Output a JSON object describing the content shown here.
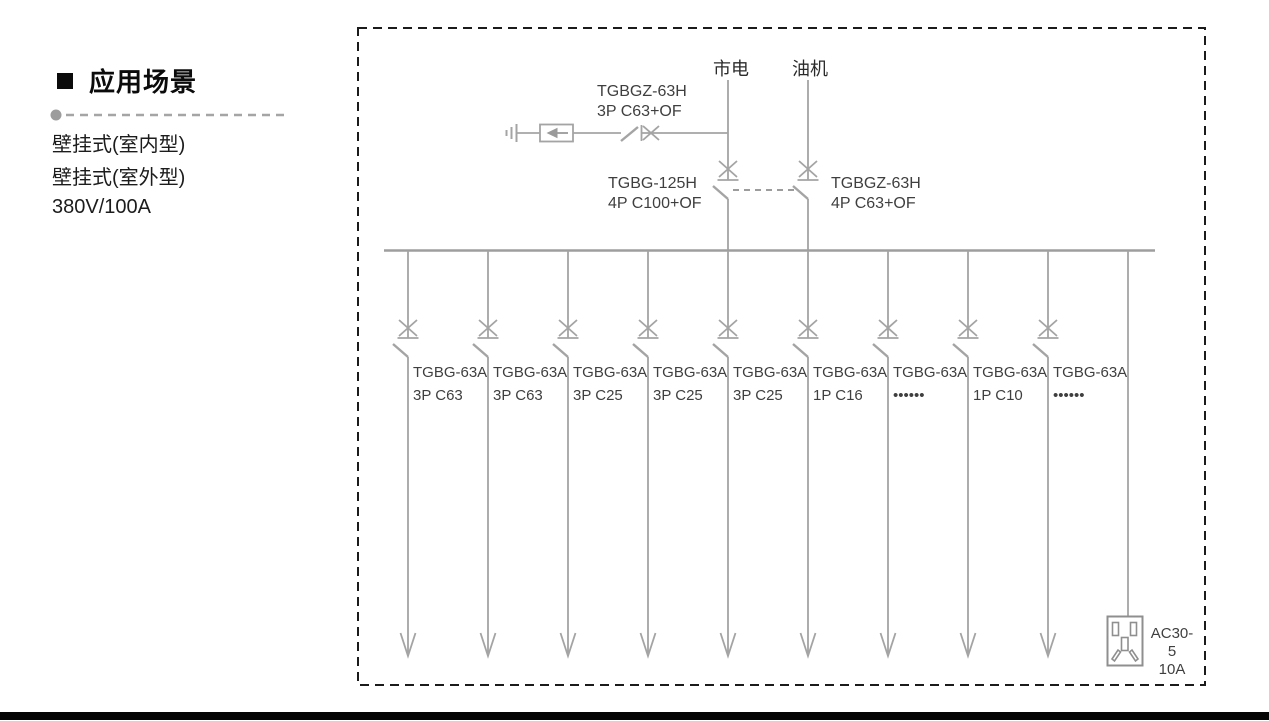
{
  "sidebar": {
    "title": "应用场景",
    "items": [
      "壁挂式(室内型)",
      "壁挂式(室外型)",
      "380V/100A"
    ]
  },
  "diagram": {
    "sources": {
      "mains": "市电",
      "generator": "油机"
    },
    "spd_breaker": {
      "model": "TGBGZ-63H",
      "spec": "3P C63+OF"
    },
    "mains_breaker": {
      "model": "TGBG-125H",
      "spec": "4P C100+OF"
    },
    "generator_breaker": {
      "model": "TGBGZ-63H",
      "spec": "4P C63+OF"
    },
    "feeders": [
      {
        "model": "TGBG-63A",
        "spec": "3P C63"
      },
      {
        "model": "TGBG-63A",
        "spec": "3P C63"
      },
      {
        "model": "TGBG-63A",
        "spec": "3P C25"
      },
      {
        "model": "TGBG-63A",
        "spec": "3P C25"
      },
      {
        "model": "TGBG-63A",
        "spec": "3P C25"
      },
      {
        "model": "TGBG-63A",
        "spec": "1P C16"
      },
      {
        "model": "TGBG-63A",
        "spec": "••••••"
      },
      {
        "model": "TGBG-63A",
        "spec": "1P C10"
      },
      {
        "model": "TGBG-63A",
        "spec": "••••••"
      }
    ],
    "socket": {
      "model": "AC30-5",
      "rating": "10A"
    }
  },
  "colors": {
    "circuit_line": "#a4a4a4",
    "diagram_text": "#3f3f3f",
    "border_dashed": "#1b1b1b",
    "footer_bar": "#050505"
  }
}
